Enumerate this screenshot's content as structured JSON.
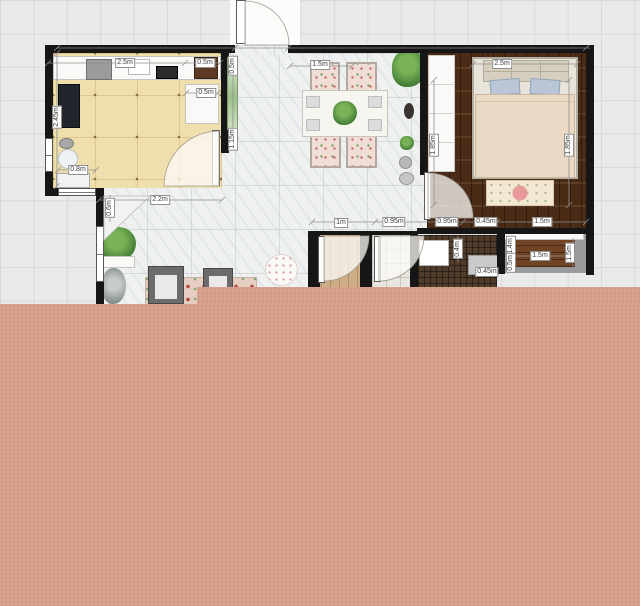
{
  "plan": {
    "dims": [
      "2.5m",
      "0.5m",
      "0.5m",
      "2.45m",
      "0.8m",
      "0.5m",
      "1.15m",
      "2.2m",
      "0.6m",
      "1.5m",
      "1.85m",
      "2.5m",
      "1.85m",
      "1m",
      "0.95m",
      "0.95m",
      "0.45m",
      "1.5m",
      "0.4m",
      "0.45m",
      "1.4m",
      "0.5m",
      "1.5m",
      "1.5m"
    ],
    "colors": {
      "background_grid": "#e9eaec",
      "grid_line": "#d8d9db",
      "wall": "#161616",
      "kitchen_floor": "#eedfad",
      "living_floor": "#eff1f0",
      "bedroom_floor": "#4a2b16",
      "hall_wood_floor": "#cdad85",
      "bathroom_mosaic": "#503c2b",
      "closet_wood": "#6f4324",
      "green_door": "#9cc089",
      "pink_overlay": "#d8a08f",
      "pillow_blue": "#b9c6d6",
      "duvet": "#ead9c4"
    }
  }
}
